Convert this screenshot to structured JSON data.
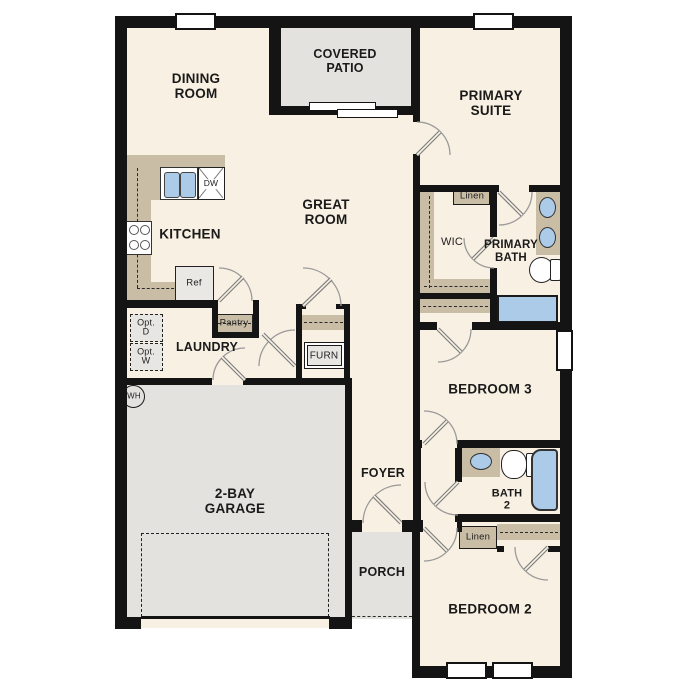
{
  "plan_title": "Single-story floor plan",
  "labels": {
    "dining_room": "DINING\nROOM",
    "covered_patio": "COVERED\nPATIO",
    "primary_suite": "PRIMARY\nSUITE",
    "kitchen": "KITCHEN",
    "great_room": "GREAT\nROOM",
    "wic": "WIC",
    "primary_bath": "PRIMARY\nBATH",
    "linen_primary": "Linen",
    "laundry": "LAUNDRY",
    "pantry": "Pantry",
    "furnace": "FURN",
    "opt_dryer": "Opt.\nD",
    "opt_washer": "Opt.\nW",
    "water_heater": "WH",
    "bedroom3": "BEDROOM 3",
    "garage": "2-BAY\nGARAGE",
    "foyer": "FOYER",
    "bath2": "BATH\n2",
    "linen_bath2": "Linen",
    "porch": "PORCH",
    "bedroom2": "BEDROOM 2",
    "dishwasher": "DW",
    "refrigerator": "Ref"
  },
  "colors": {
    "floor": "#f8f0e2",
    "exterior_area": "#e3e2df",
    "counter_tan": "#cabda5",
    "fixture_blue": "#abcbe9",
    "wall": "#141414",
    "door": "#8a8a8a",
    "text": "#1a1a1a"
  }
}
